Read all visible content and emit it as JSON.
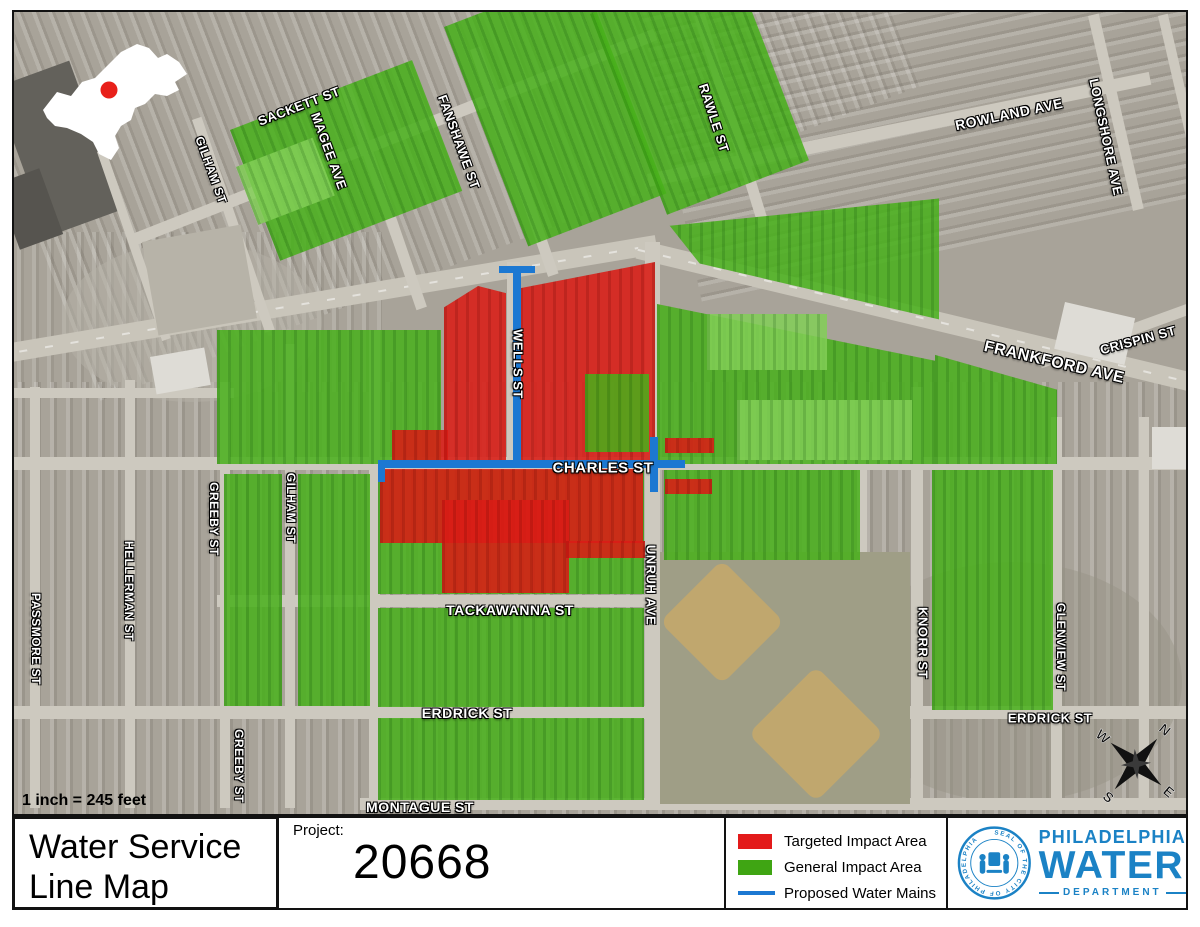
{
  "map": {
    "scale_text": "1 inch = 245 feet",
    "compass": {
      "n": "N",
      "e": "E",
      "s": "S",
      "w": "W"
    },
    "colors": {
      "targeted_impact": "#e31a1a",
      "general_impact": "#3fa513",
      "proposed_mains": "#1c78d2",
      "inset_marker": "#e8201a"
    },
    "street_labels": [
      {
        "text": "SACKETT ST",
        "x": 297,
        "y": 104,
        "rot": -21,
        "size": 13
      },
      {
        "text": "MAGEE AVE",
        "x": 327,
        "y": 149,
        "rot": 70,
        "size": 13
      },
      {
        "text": "FANSHAWE ST",
        "x": 457,
        "y": 140,
        "rot": 70,
        "size": 13
      },
      {
        "text": "RAWLE ST",
        "x": 712,
        "y": 116,
        "rot": 72,
        "size": 13
      },
      {
        "text": "GILHAM ST",
        "x": 209,
        "y": 168,
        "rot": 70,
        "size": 12
      },
      {
        "text": "ROWLAND AVE",
        "x": 1007,
        "y": 112,
        "rot": -12,
        "size": 14
      },
      {
        "text": "LONGSHORE AVE",
        "x": 1104,
        "y": 135,
        "rot": 78,
        "size": 13
      },
      {
        "text": "CRISPIN ST",
        "x": 1136,
        "y": 338,
        "rot": -15,
        "size": 13
      },
      {
        "text": "FRANKFORD AVE",
        "x": 1052,
        "y": 361,
        "rot": 13,
        "size": 16
      },
      {
        "text": "WELLS ST",
        "x": 516,
        "y": 362,
        "rot": 90,
        "size": 13
      },
      {
        "text": "CHARLES ST",
        "x": 601,
        "y": 466,
        "rot": 0,
        "size": 15
      },
      {
        "text": "UNRUH AVE",
        "x": 649,
        "y": 583,
        "rot": 90,
        "size": 13
      },
      {
        "text": "GILHAM ST",
        "x": 289,
        "y": 506,
        "rot": 90,
        "size": 12
      },
      {
        "text": "GREEBY ST",
        "x": 212,
        "y": 517,
        "rot": 90,
        "size": 12
      },
      {
        "text": "HELLERMAN ST",
        "x": 127,
        "y": 589,
        "rot": 90,
        "size": 12
      },
      {
        "text": "PASSMORE ST",
        "x": 34,
        "y": 637,
        "rot": 90,
        "size": 12
      },
      {
        "text": "GREEBY ST",
        "x": 237,
        "y": 764,
        "rot": 90,
        "size": 12
      },
      {
        "text": "TACKAWANNA ST",
        "x": 508,
        "y": 608,
        "rot": 0,
        "size": 14
      },
      {
        "text": "ERDRICK ST",
        "x": 465,
        "y": 711,
        "rot": 0,
        "size": 14
      },
      {
        "text": "ERDRICK ST",
        "x": 1048,
        "y": 716,
        "rot": 0,
        "size": 13
      },
      {
        "text": "MONTAGUE ST",
        "x": 418,
        "y": 805,
        "rot": 0,
        "size": 14
      },
      {
        "text": "KNORR ST",
        "x": 921,
        "y": 641,
        "rot": 90,
        "size": 13
      },
      {
        "text": "GLENVIEW ST",
        "x": 1059,
        "y": 645,
        "rot": 90,
        "size": 12
      }
    ]
  },
  "footer": {
    "title": {
      "line1": "Water Service",
      "line2": "Line Map"
    },
    "project": {
      "label": "Project:",
      "number": "20668"
    },
    "legend": {
      "items": [
        {
          "label": "Targeted Impact Area"
        },
        {
          "label": "General Impact Area"
        },
        {
          "label": "Proposed Water Mains"
        }
      ]
    },
    "logo": {
      "org_line1": "PHILADELPHIA",
      "org_line2": "WATER",
      "org_line3": "DEPARTMENT",
      "seal_text": "SEAL OF THE CITY OF PHILADELPHIA",
      "brand_color": "#1b82c5"
    }
  }
}
